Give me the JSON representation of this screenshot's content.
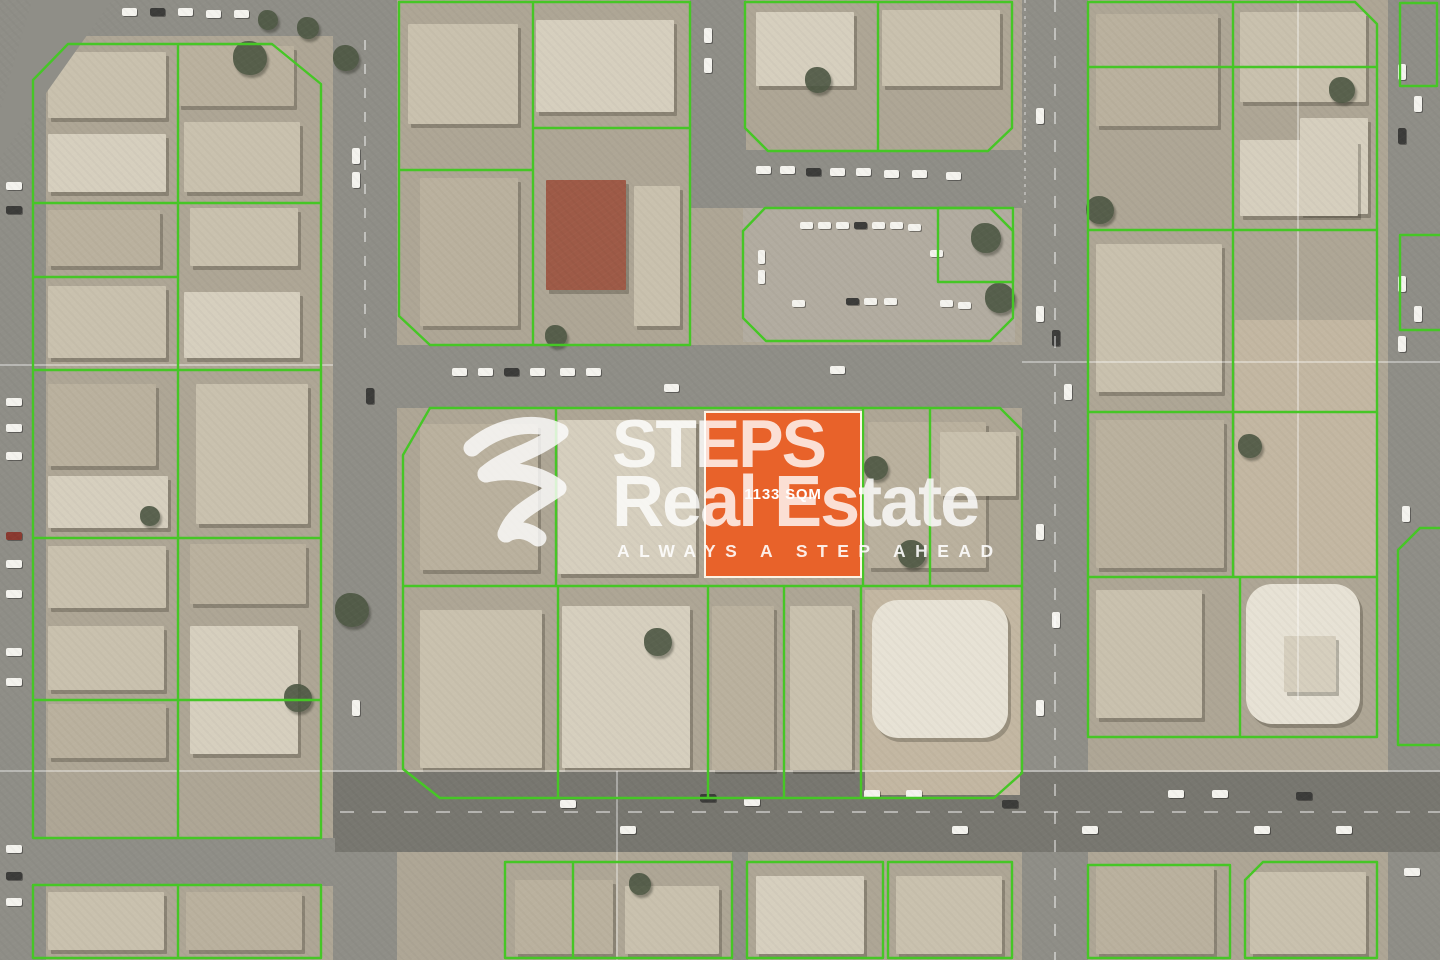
{
  "title": "STEPS Real Estate",
  "watermark": {
    "brand_line1": "STEPS",
    "brand_line2": "Real Estate",
    "tagline": "ALWAYS A STEP AHEAD"
  },
  "plot": {
    "area_label": "1133 SQM",
    "x": 704,
    "y": 411,
    "w": 158,
    "h": 167,
    "fill": "#E8622A",
    "border": "#FDF3E4"
  },
  "map": {
    "colors": {
      "base": "#aea695",
      "road": "#8f8e87",
      "roadDark": "#787770",
      "parking": "#b2aca0",
      "green": "#46c626",
      "tree": "#4d5743",
      "hairline": "rgba(255,255,255,0.6)",
      "lane": "rgba(255,255,255,0.45)",
      "palette": {
        "a": "#c9c1ae",
        "b": "#bab19e",
        "c": "#d6cfbe",
        "d": "#a29b8d",
        "e": "#e7e2d5",
        "r": "#9e5a47",
        "w": "#f4f3ee",
        "k": "#3c3c3a",
        "x": "#8a3a30",
        "s": "#c3b7a2"
      }
    },
    "roads": [
      {
        "x": 0,
        "y": 0,
        "w": 46,
        "h": 960
      },
      {
        "x": 333,
        "y": 0,
        "w": 64,
        "h": 960
      },
      {
        "x": 1022,
        "y": 0,
        "w": 66,
        "h": 960
      },
      {
        "x": 1388,
        "y": 0,
        "w": 52,
        "h": 960
      },
      {
        "x": 40,
        "y": 0,
        "w": 295,
        "h": 36
      },
      {
        "x": 690,
        "y": 0,
        "w": 56,
        "h": 208
      },
      {
        "x": 690,
        "y": 150,
        "w": 335,
        "h": 58
      },
      {
        "x": 397,
        "y": 345,
        "w": 630,
        "h": 63
      },
      {
        "x": 333,
        "y": 772,
        "w": 1107,
        "h": 80,
        "c": "roadDark"
      },
      {
        "x": 0,
        "y": 838,
        "w": 335,
        "h": 48
      },
      {
        "x": 732,
        "y": 852,
        "w": 16,
        "h": 108
      }
    ],
    "diagonal_road": "0,158 112,0 32,0 0,112",
    "grounds": [
      {
        "x": 743,
        "y": 208,
        "w": 272,
        "h": 134,
        "c": "parking"
      },
      {
        "x": 1235,
        "y": 320,
        "w": 143,
        "h": 258,
        "c": "s"
      },
      {
        "x": 865,
        "y": 590,
        "w": 155,
        "h": 205,
        "c": "s"
      }
    ],
    "buildings": [
      [
        48,
        52,
        118,
        66,
        "a"
      ],
      [
        178,
        46,
        116,
        60,
        "b"
      ],
      [
        48,
        134,
        118,
        58,
        "c"
      ],
      [
        184,
        122,
        116,
        70,
        "a"
      ],
      [
        48,
        210,
        112,
        56,
        "b"
      ],
      [
        190,
        208,
        108,
        58,
        "a"
      ],
      [
        48,
        286,
        118,
        72,
        "a"
      ],
      [
        184,
        292,
        116,
        66,
        "c"
      ],
      [
        48,
        384,
        108,
        82,
        "b"
      ],
      [
        196,
        384,
        112,
        140,
        "a"
      ],
      [
        48,
        476,
        120,
        52,
        "c"
      ],
      [
        48,
        546,
        118,
        62,
        "a"
      ],
      [
        190,
        544,
        116,
        60,
        "b"
      ],
      [
        48,
        626,
        116,
        64,
        "a"
      ],
      [
        190,
        626,
        108,
        128,
        "c"
      ],
      [
        48,
        704,
        118,
        54,
        "b"
      ],
      [
        48,
        892,
        116,
        58,
        "a"
      ],
      [
        186,
        892,
        116,
        58,
        "b"
      ],
      [
        408,
        24,
        110,
        100,
        "a"
      ],
      [
        536,
        20,
        138,
        92,
        "c"
      ],
      [
        420,
        178,
        98,
        148,
        "b"
      ],
      [
        546,
        180,
        80,
        110,
        "r"
      ],
      [
        634,
        186,
        46,
        140,
        "a"
      ],
      [
        756,
        12,
        98,
        74,
        "c"
      ],
      [
        882,
        10,
        118,
        76,
        "a"
      ],
      [
        1096,
        14,
        122,
        112,
        "b"
      ],
      [
        1240,
        12,
        126,
        90,
        "a"
      ],
      [
        1300,
        118,
        68,
        96,
        "c"
      ],
      [
        1240,
        140,
        118,
        76,
        "c"
      ],
      [
        1096,
        244,
        126,
        148,
        "a"
      ],
      [
        1096,
        420,
        128,
        148,
        "b"
      ],
      [
        1096,
        590,
        106,
        128,
        "a"
      ],
      [
        1246,
        584,
        114,
        140,
        "e"
      ],
      [
        1284,
        636,
        52,
        56,
        "c"
      ],
      [
        420,
        424,
        118,
        146,
        "b"
      ],
      [
        558,
        420,
        138,
        154,
        "c"
      ],
      [
        868,
        422,
        118,
        146,
        "b"
      ],
      [
        940,
        432,
        76,
        64,
        "a"
      ],
      [
        420,
        610,
        122,
        158,
        "a"
      ],
      [
        562,
        606,
        128,
        162,
        "c"
      ],
      [
        712,
        606,
        62,
        164,
        "b"
      ],
      [
        790,
        606,
        62,
        164,
        "a"
      ],
      [
        872,
        600,
        136,
        138,
        "e"
      ],
      [
        515,
        880,
        98,
        74,
        "b"
      ],
      [
        625,
        886,
        94,
        68,
        "a"
      ],
      [
        756,
        876,
        108,
        78,
        "c"
      ],
      [
        896,
        876,
        106,
        78,
        "a"
      ],
      [
        1096,
        866,
        118,
        88,
        "b"
      ],
      [
        1250,
        872,
        116,
        82,
        "a"
      ]
    ],
    "trees": [
      [
        250,
        58,
        34
      ],
      [
        346,
        58,
        26
      ],
      [
        268,
        20,
        20
      ],
      [
        308,
        28,
        22
      ],
      [
        818,
        80,
        26
      ],
      [
        986,
        238,
        30
      ],
      [
        1000,
        298,
        30
      ],
      [
        556,
        336,
        22
      ],
      [
        912,
        554,
        28
      ],
      [
        876,
        468,
        24
      ],
      [
        658,
        642,
        28
      ],
      [
        352,
        610,
        34
      ],
      [
        298,
        698,
        28
      ],
      [
        1100,
        210,
        28
      ],
      [
        1250,
        446,
        24
      ],
      [
        1342,
        90,
        26
      ],
      [
        640,
        884,
        22
      ],
      [
        150,
        516,
        20
      ]
    ],
    "cars": [
      [
        122,
        8,
        15,
        8,
        "w"
      ],
      [
        150,
        8,
        15,
        8,
        "k"
      ],
      [
        178,
        8,
        15,
        8,
        "w"
      ],
      [
        206,
        10,
        15,
        8,
        "w"
      ],
      [
        234,
        10,
        15,
        8,
        "w"
      ],
      [
        30,
        44,
        14,
        8,
        "k"
      ],
      [
        20,
        60,
        8,
        14,
        "w"
      ],
      [
        24,
        76,
        8,
        14,
        "w"
      ],
      [
        704,
        28,
        8,
        15,
        "w"
      ],
      [
        704,
        58,
        8,
        15,
        "w"
      ],
      [
        756,
        166,
        15,
        8,
        "w"
      ],
      [
        780,
        166,
        15,
        8,
        "w"
      ],
      [
        806,
        168,
        15,
        8,
        "k"
      ],
      [
        830,
        168,
        15,
        8,
        "w"
      ],
      [
        856,
        168,
        15,
        8,
        "w"
      ],
      [
        884,
        170,
        15,
        8,
        "w"
      ],
      [
        912,
        170,
        15,
        8,
        "w"
      ],
      [
        946,
        172,
        15,
        8,
        "w"
      ],
      [
        800,
        222,
        13,
        7,
        "w"
      ],
      [
        818,
        222,
        13,
        7,
        "w"
      ],
      [
        836,
        222,
        13,
        7,
        "w"
      ],
      [
        854,
        222,
        13,
        7,
        "k"
      ],
      [
        872,
        222,
        13,
        7,
        "w"
      ],
      [
        890,
        222,
        13,
        7,
        "w"
      ],
      [
        908,
        224,
        13,
        7,
        "w"
      ],
      [
        930,
        250,
        13,
        7,
        "w"
      ],
      [
        758,
        250,
        7,
        14,
        "w"
      ],
      [
        758,
        270,
        7,
        14,
        "w"
      ],
      [
        792,
        300,
        13,
        7,
        "w"
      ],
      [
        846,
        298,
        13,
        7,
        "k"
      ],
      [
        864,
        298,
        13,
        7,
        "w"
      ],
      [
        884,
        298,
        13,
        7,
        "w"
      ],
      [
        940,
        300,
        13,
        7,
        "w"
      ],
      [
        958,
        302,
        13,
        7,
        "w"
      ],
      [
        6,
        182,
        16,
        8,
        "w"
      ],
      [
        6,
        206,
        16,
        8,
        "k"
      ],
      [
        6,
        398,
        16,
        8,
        "w"
      ],
      [
        6,
        424,
        16,
        8,
        "w"
      ],
      [
        6,
        452,
        16,
        8,
        "w"
      ],
      [
        6,
        532,
        16,
        8,
        "x"
      ],
      [
        6,
        560,
        16,
        8,
        "w"
      ],
      [
        6,
        590,
        16,
        8,
        "w"
      ],
      [
        6,
        648,
        16,
        8,
        "w"
      ],
      [
        6,
        678,
        16,
        8,
        "w"
      ],
      [
        6,
        845,
        16,
        8,
        "w"
      ],
      [
        6,
        872,
        16,
        8,
        "k"
      ],
      [
        6,
        898,
        16,
        8,
        "w"
      ],
      [
        352,
        148,
        8,
        16,
        "w"
      ],
      [
        352,
        172,
        8,
        16,
        "w"
      ],
      [
        366,
        388,
        8,
        16,
        "k"
      ],
      [
        352,
        700,
        8,
        16,
        "w"
      ],
      [
        1036,
        108,
        8,
        16,
        "w"
      ],
      [
        1064,
        384,
        8,
        16,
        "w"
      ],
      [
        1036,
        306,
        8,
        16,
        "w"
      ],
      [
        1052,
        330,
        8,
        16,
        "k"
      ],
      [
        1036,
        524,
        8,
        16,
        "w"
      ],
      [
        1052,
        612,
        8,
        16,
        "w"
      ],
      [
        1036,
        700,
        8,
        16,
        "w"
      ],
      [
        1398,
        64,
        8,
        16,
        "w"
      ],
      [
        1414,
        96,
        8,
        16,
        "w"
      ],
      [
        1398,
        128,
        8,
        16,
        "k"
      ],
      [
        1398,
        276,
        8,
        16,
        "w"
      ],
      [
        1414,
        306,
        8,
        16,
        "w"
      ],
      [
        1398,
        336,
        8,
        16,
        "w"
      ],
      [
        1402,
        506,
        8,
        16,
        "w"
      ],
      [
        1404,
        868,
        16,
        8,
        "w"
      ],
      [
        560,
        800,
        16,
        8,
        "w"
      ],
      [
        620,
        826,
        16,
        8,
        "w"
      ],
      [
        700,
        794,
        16,
        8,
        "k"
      ],
      [
        744,
        798,
        16,
        8,
        "w"
      ],
      [
        864,
        790,
        16,
        8,
        "w"
      ],
      [
        906,
        790,
        16,
        8,
        "w"
      ],
      [
        952,
        826,
        16,
        8,
        "w"
      ],
      [
        1002,
        800,
        16,
        8,
        "k"
      ],
      [
        1082,
        826,
        16,
        8,
        "w"
      ],
      [
        1168,
        790,
        16,
        8,
        "w"
      ],
      [
        1212,
        790,
        16,
        8,
        "w"
      ],
      [
        1254,
        826,
        16,
        8,
        "w"
      ],
      [
        1296,
        792,
        16,
        8,
        "k"
      ],
      [
        1336,
        826,
        16,
        8,
        "w"
      ],
      [
        452,
        368,
        15,
        8,
        "w"
      ],
      [
        478,
        368,
        15,
        8,
        "w"
      ],
      [
        504,
        368,
        15,
        8,
        "k"
      ],
      [
        530,
        368,
        15,
        8,
        "w"
      ],
      [
        560,
        368,
        15,
        8,
        "w"
      ],
      [
        586,
        368,
        15,
        8,
        "w"
      ],
      [
        664,
        384,
        15,
        8,
        "w"
      ],
      [
        830,
        366,
        15,
        8,
        "w"
      ]
    ],
    "parcels": [
      [
        "p",
        "33,80 68,44 272,44 321,84 321,838 33,838"
      ],
      [
        "l",
        "33,203 321,203"
      ],
      [
        "l",
        "33,277 178,277"
      ],
      [
        "l",
        "178,44 178,838"
      ],
      [
        "l",
        "33,370 321,370"
      ],
      [
        "l",
        "33,538 321,538"
      ],
      [
        "l",
        "33,700 321,700"
      ],
      [
        "p",
        "33,885 321,885 321,958 33,958"
      ],
      [
        "l",
        "178,885 178,958"
      ],
      [
        "p",
        "399,2 690,2 690,345 430,345 399,316"
      ],
      [
        "l",
        "533,2 533,345"
      ],
      [
        "l",
        "399,170 533,170"
      ],
      [
        "l",
        "533,128 690,128"
      ],
      [
        "p",
        "745,2 1012,2 1012,128 988,151 768,151 745,128"
      ],
      [
        "l",
        "878,2 878,151"
      ],
      [
        "p",
        "765,208 990,208 1013,231 1013,318 990,341 766,341 743,318 743,231"
      ],
      [
        "p",
        "938,208 1013,208 1013,282 938,282"
      ],
      [
        "p",
        "1088,2 1355,2 1377,24 1377,737 1088,737"
      ],
      [
        "l",
        "1088,67 1377,67"
      ],
      [
        "l",
        "1088,230 1377,230"
      ],
      [
        "l",
        "1088,412 1377,412"
      ],
      [
        "l",
        "1088,577 1377,577"
      ],
      [
        "l",
        "1233,2 1233,577"
      ],
      [
        "l",
        "1240,577 1240,737"
      ],
      [
        "p",
        "430,408 1000,408 1022,430 1022,773 994,798 440,798 403,769 403,455"
      ],
      [
        "l",
        "403,586 1022,586"
      ],
      [
        "l",
        "556,408 556,586"
      ],
      [
        "l",
        "863,408 863,586"
      ],
      [
        "l",
        "930,408 930,586"
      ],
      [
        "l",
        "558,586 558,798"
      ],
      [
        "l",
        "708,586 708,798"
      ],
      [
        "l",
        "784,586 784,798"
      ],
      [
        "l",
        "861,586 861,798"
      ],
      [
        "p",
        "505,862 732,862 732,958 505,958"
      ],
      [
        "p",
        "747,862 883,862 883,958 747,958"
      ],
      [
        "p",
        "888,862 1012,862 1012,958 888,958"
      ],
      [
        "l",
        "573,862 573,958"
      ],
      [
        "p",
        "1088,865 1230,865 1230,958 1088,958"
      ],
      [
        "p",
        "1263,862 1377,862 1377,958 1245,958 1245,880"
      ],
      [
        "p",
        "1400,3 1437,3 1437,86 1400,86"
      ],
      [
        "l",
        "1440,235 1400,235 1400,330 1440,330"
      ],
      [
        "l",
        "1440,528 1420,528 1398,550 1398,745 1440,745"
      ]
    ],
    "hairlines": [
      {
        "pts": "0,365 333,365"
      },
      {
        "pts": "1022,362 1440,362"
      },
      {
        "pts": "0,771 1440,771"
      },
      {
        "pts": "617,771 617,960"
      },
      {
        "pts": "1298,0 1298,700"
      },
      {
        "pts": "1025,0 1025,205",
        "dash": "3 5"
      }
    ],
    "lane_marks": [
      {
        "pts": "1055,0 1055,960",
        "dash": "12 16"
      },
      {
        "pts": "340,812 1440,812",
        "dash": "14 18"
      },
      {
        "pts": "365,40 365,340",
        "dash": "10 14"
      }
    ]
  }
}
